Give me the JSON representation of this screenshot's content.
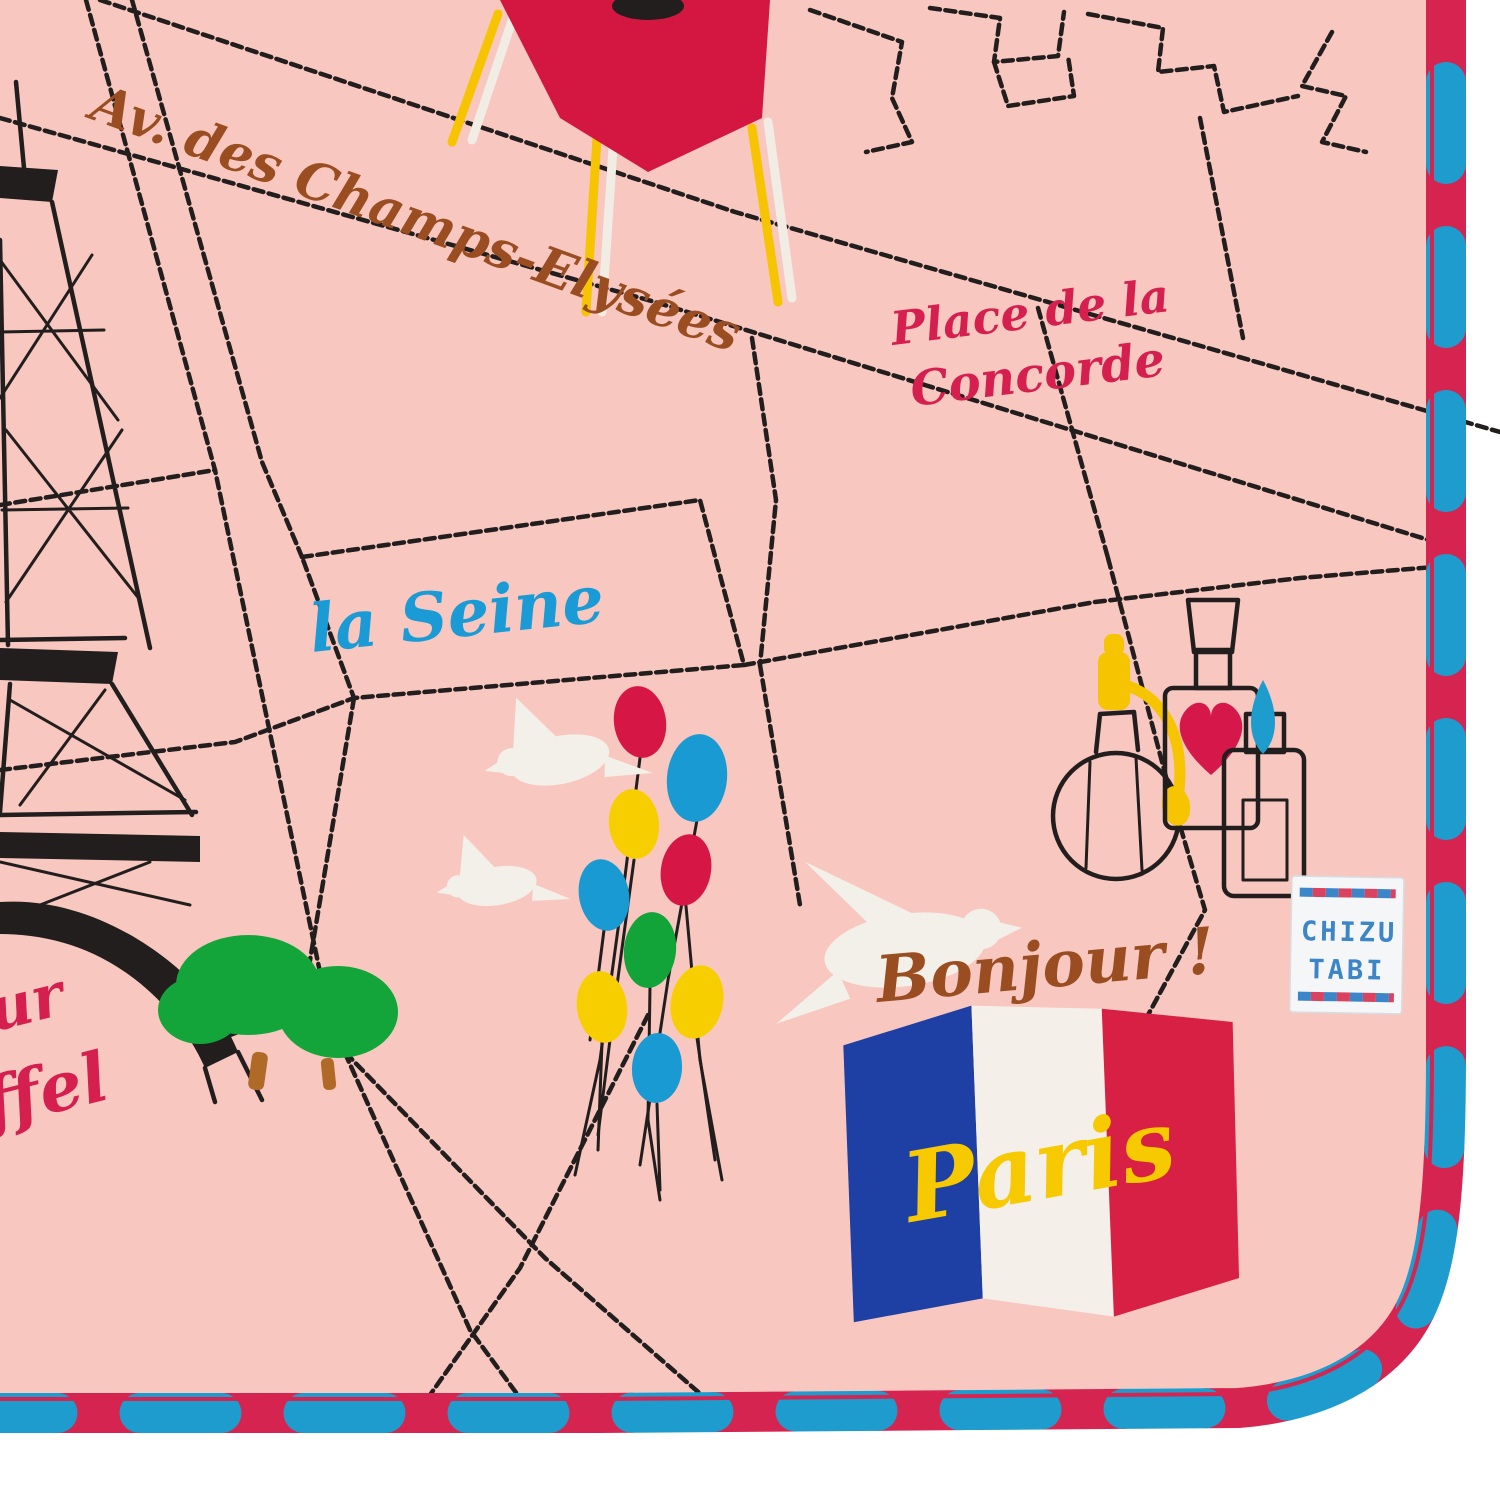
{
  "labels": {
    "avenue": "Av. des Champs-Elysées",
    "concorde_line1": "Place de la",
    "concorde_line2": "Concorde",
    "seine": "la Seine",
    "bonjour": "Bonjour !",
    "paris": "Paris",
    "eiffel_fragment_line1": "ur",
    "eiffel_fragment_line2": "ffel",
    "brand_line1": "CHIZU",
    "brand_line2": "TABI"
  },
  "colors": {
    "background": "#ffffff",
    "towel_pink": "#f8c7c0",
    "stitch_black": "#221e1d",
    "trim_red": "#d62450",
    "trim_blue": "#1e9ccd",
    "text_brown": "#9a4d20",
    "text_red": "#d51f4e",
    "text_blue": "#1b9bd5",
    "text_yellow": "#f7c900",
    "flag_blue": "#1e3fa3",
    "flag_white": "#f4efe9",
    "flag_red": "#d81f44",
    "dove_white": "#f3efe9",
    "tree_green": "#14a53a",
    "trunk_brown": "#b06a28",
    "chair_red": "#d41740",
    "leg_yellow": "#f6c400",
    "leg_white": "#f1ece4",
    "heart_red": "#d6174a",
    "stopper_yellow": "#f6c400",
    "stopper_blue": "#1e9ccd",
    "tag_white": "#f4f6f8",
    "tag_blue": "#3c85c8",
    "tag_red": "#d6304e"
  },
  "balloon_colors": [
    "#d61745",
    "#1a9ad2",
    "#f7ce00",
    "#d61745",
    "#1a9ad2",
    "#12a339",
    "#f7ce00",
    "#f7ce00",
    "#1a9ad2"
  ]
}
